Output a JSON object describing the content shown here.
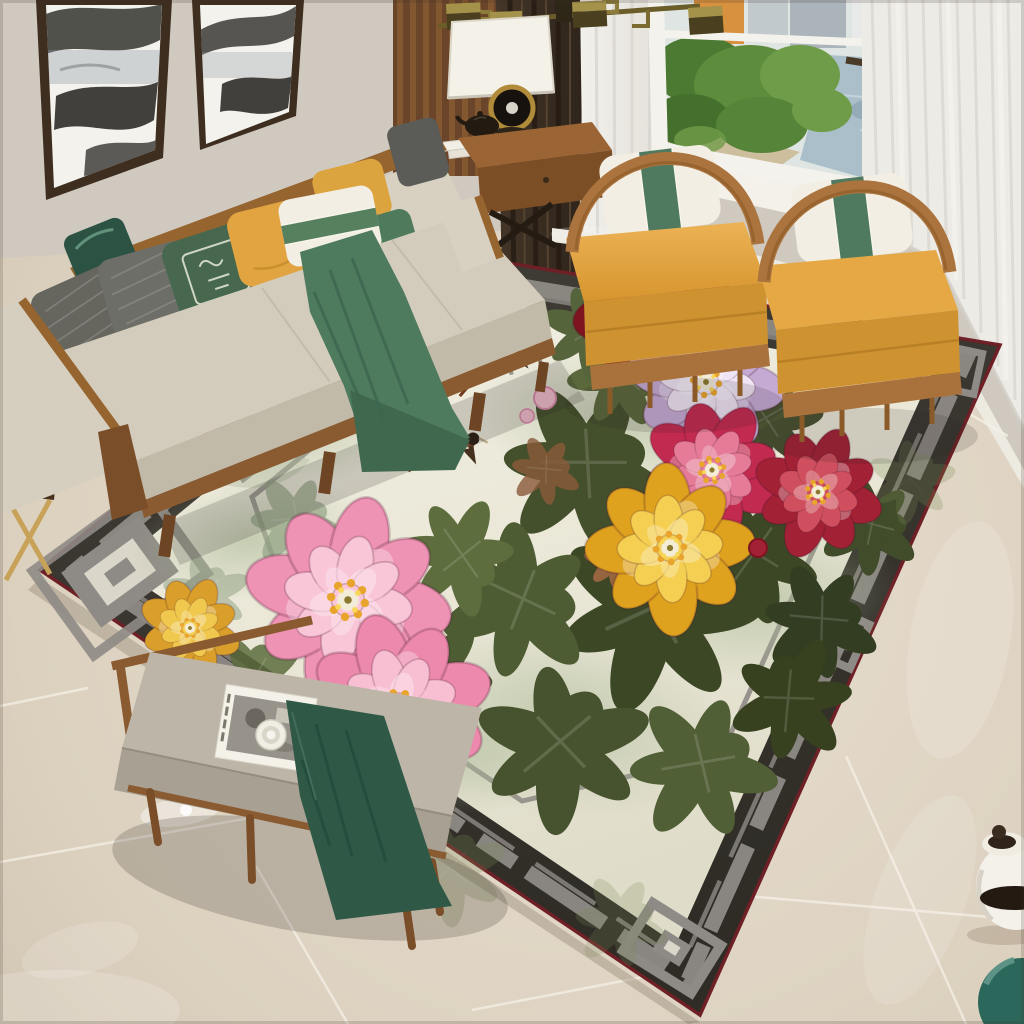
{
  "meta": {
    "image_type": "interior product photograph",
    "description": "Overhead view of a modern Chinese-style living room: beige wood-frame sofa with yellow, green and grey pillows, two yellow hoop armchairs by a city-view window, a grey bench with a magazine and teacup, and a large cream area rug painted with pink, yellow, red and lavender peonies, two long-tailed birds and a charcoal Chinese-fret border, all on polished beige marble tile.",
    "visible_text": "none"
  },
  "palette": {
    "wall": "#cfc9bf",
    "floor_light": "#e9dfd0",
    "floor_dark": "#cfc3b0",
    "grout": "#f7f2e8",
    "baseboard": "#edeae2",
    "rug_border": "#3a3731",
    "rug_fret_grey": "#8e8a85",
    "rug_trim_maroon": "#6e2026",
    "rug_field": "#edeadb",
    "rug_wash_green": "#b0bea0",
    "foliage_dark": "#3c4726",
    "foliage_mid": "#4d5c33",
    "foliage_sage": "#8fa080",
    "peony_pink": "#ee93b4",
    "peony_pink2": "#ec89ac",
    "peony_yellow": "#dfa21e",
    "peony_magenta": "#c22a50",
    "peony_dark_red": "#7e1420",
    "peony_lavender": "#c5abd4",
    "peony_red": "#a32135",
    "peony_gold_small": "#d99f2a",
    "stamen_gold": "#e8a42c",
    "bird_brown": "#8a4a2e",
    "sofa_fabric": "#d8d1c2",
    "sofa_wood": "#96642f",
    "pillow_grey": "#6e6e68",
    "pillow_green": "#4f7a5c",
    "pillow_green_pattern": "#47684f",
    "pillow_yellow": "#e2a440",
    "pillow_white": "#f2eee3",
    "pillow_dark_green": "#2c5244",
    "throw_green": "#4e7a5e",
    "bench_cushion": "#bdb5a7",
    "bench_throw_green": "#2f5847",
    "chair_yellow": "#e5a845",
    "chair_yellow_front": "#cf9231",
    "chair_wood": "#ab733d",
    "curtain_dark": "#3a2e24",
    "sheer_white": "#edebe6",
    "window_frame": "#f4f2ec",
    "window_water": "#aabfca",
    "window_tree": "#5d8c3c",
    "lamp_shade": "#f4f1e8",
    "brass": "#8c7c3c",
    "magazine_white": "#f4f1e8",
    "jar_white": "#f4f1ea",
    "vase_teal": "#2c675c",
    "table_wood": "#9a6434"
  },
  "objects": {
    "scene": "living room with floral chinese rug",
    "marble_floor": "polished beige marble tile floor",
    "wall": "light grey wall",
    "wall_art_left": "framed ink mountain painting",
    "wall_art_right": "framed ink mountain painting",
    "slat_panel": "wood slat wall panel",
    "curtain_dark": "dark brown curtain",
    "sheer_left": "white sheer curtain",
    "sheer_right": "white sheer curtain",
    "window": "window with park and city view",
    "ceiling_lamp": "brass chinese fret chandelier",
    "sofa": "beige wood-frame sofa with pillows",
    "sofa_throw": "green throw blanket",
    "lamp_table": "wood side table with lamp",
    "table_lamp": "white shade table lamp",
    "teapot": "dark clay teapot",
    "armchair_left": "yellow hoop armchair",
    "armchair_right": "yellow hoop armchair",
    "area_rug": "peony and bird chinese fret rug",
    "rug_birds": "two long-tailed birds",
    "bench": "grey upholstered bench",
    "bench_throw": "dark green throw",
    "magazine": "magazine with teacup",
    "console_table": "small wood table with gold legs",
    "white_jar": "white ginger jar",
    "teal_vase": "teal round vase"
  }
}
